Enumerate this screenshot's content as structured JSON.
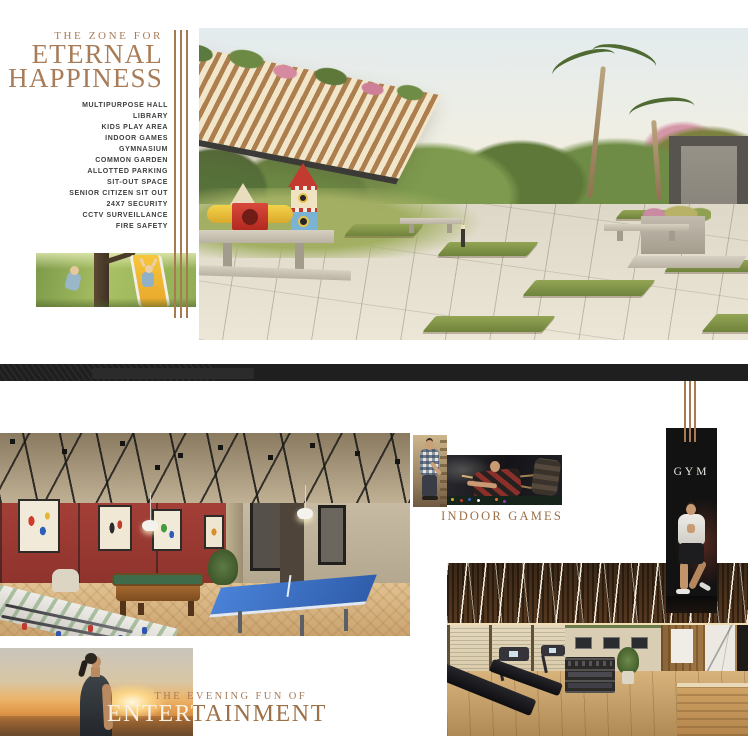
{
  "colors": {
    "accent": "#a87c58",
    "accent_deep": "#9c7048",
    "spine_band": "#1f1f1f",
    "list_text": "#3e3e3e",
    "gym_banner_bg": "#121212"
  },
  "zone_section": {
    "kicker": "THE ZONE FOR",
    "title_line1": "ETERNAL",
    "title_line2": "HAPPINESS",
    "amenities": [
      "MULTIPURPOSE HALL",
      "LIBRARY",
      "KIDS PLAY AREA",
      "INDOOR GAMES",
      "GYMNASIUM",
      "COMMON GARDEN",
      "ALLOTTED PARKING",
      "SIT-OUT SPACE",
      "SENIOR CITIZEN SIT OUT",
      "24X7 SECURITY",
      "CCTV SURVEILLANCE",
      "FIRE SAFETY"
    ]
  },
  "entertainment_section": {
    "indoor_games_label": "INDOOR GAMES",
    "gym_label": "GYM",
    "kicker": "THE EVENING FUN OF",
    "title": "ENTERTAINMENT"
  }
}
